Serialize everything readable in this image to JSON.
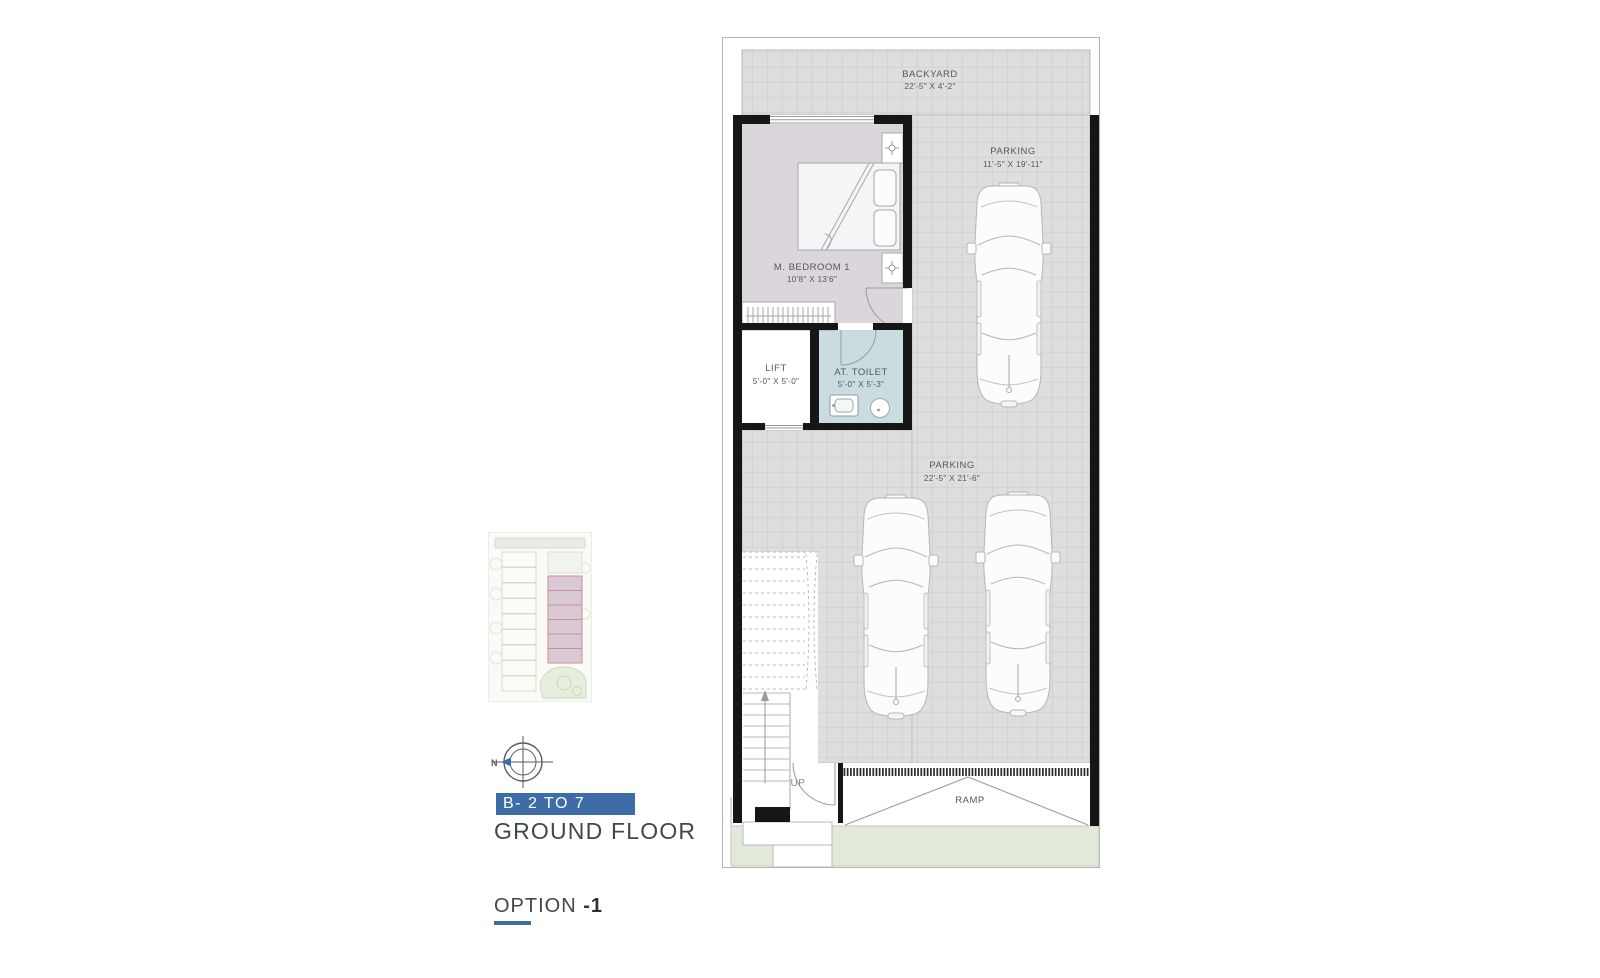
{
  "plan": {
    "rooms": {
      "backyard": {
        "name": "BACKYARD",
        "dims": "22'-5\" X 4'-2\""
      },
      "parking1": {
        "name": "PARKING",
        "dims": "11'-5\" X 19'-11\""
      },
      "bedroom": {
        "name": "M. BEDROOM 1",
        "dims": "10'8\" X 13'6\""
      },
      "lift": {
        "name": "LIFT",
        "dims": "5'-0\" X 5'-0\""
      },
      "toilet": {
        "name": "AT. TOILET",
        "dims": "5'-0\" X 5'-3\""
      },
      "parking2": {
        "name": "PARKING",
        "dims": "22'-5\" X 21'-6\""
      },
      "ramp": {
        "name": "RAMP"
      },
      "stairs": {
        "direction_label": "UP"
      }
    }
  },
  "legend": {
    "compass_north_label": "N",
    "block_badge": "B- 2 TO 7",
    "floor_title": "GROUND FLOOR",
    "option_prefix": "OPTION ",
    "option_number": "-1",
    "accent_blue": "#3e6ca6"
  }
}
